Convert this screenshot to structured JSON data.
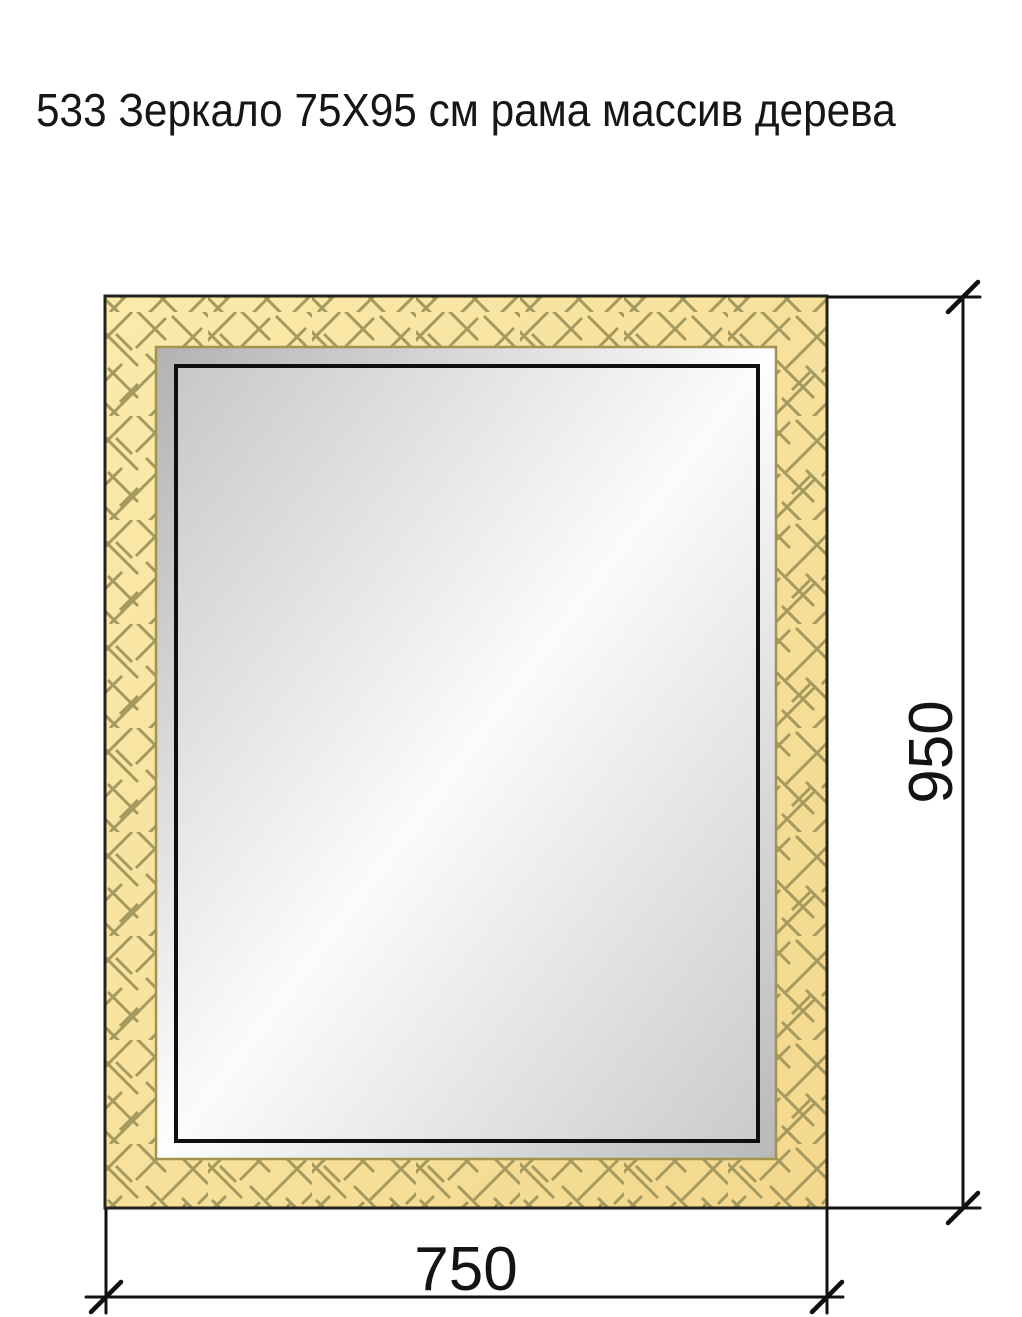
{
  "title": {
    "text": "533 Зеркало 75X95 см рама массив дерева"
  },
  "drawing": {
    "object": "mirror-front-view-technical-drawing",
    "width_dimension": {
      "label": "750"
    },
    "height_dimension": {
      "label": "950"
    },
    "colors": {
      "background": "#ffffff",
      "frame_fill_light": "#fbeaab",
      "frame_fill_dark": "#f3d88d",
      "frame_hatch": "#a49a60",
      "frame_inner_edge": "#a3934f",
      "frame_outline": "#23231a",
      "bevel_dark_a": "#b2b2b2",
      "bevel_mid": "#fefefe",
      "bevel_dark_b": "#b8b8b8",
      "glass_dark_a": "#c6c8c9",
      "glass_mid": "#fafbfc",
      "glass_dark_b": "#c9cbcc",
      "glass_border": "#0f0f0f",
      "dimension_lines": "#111111",
      "text": "#141414"
    }
  }
}
